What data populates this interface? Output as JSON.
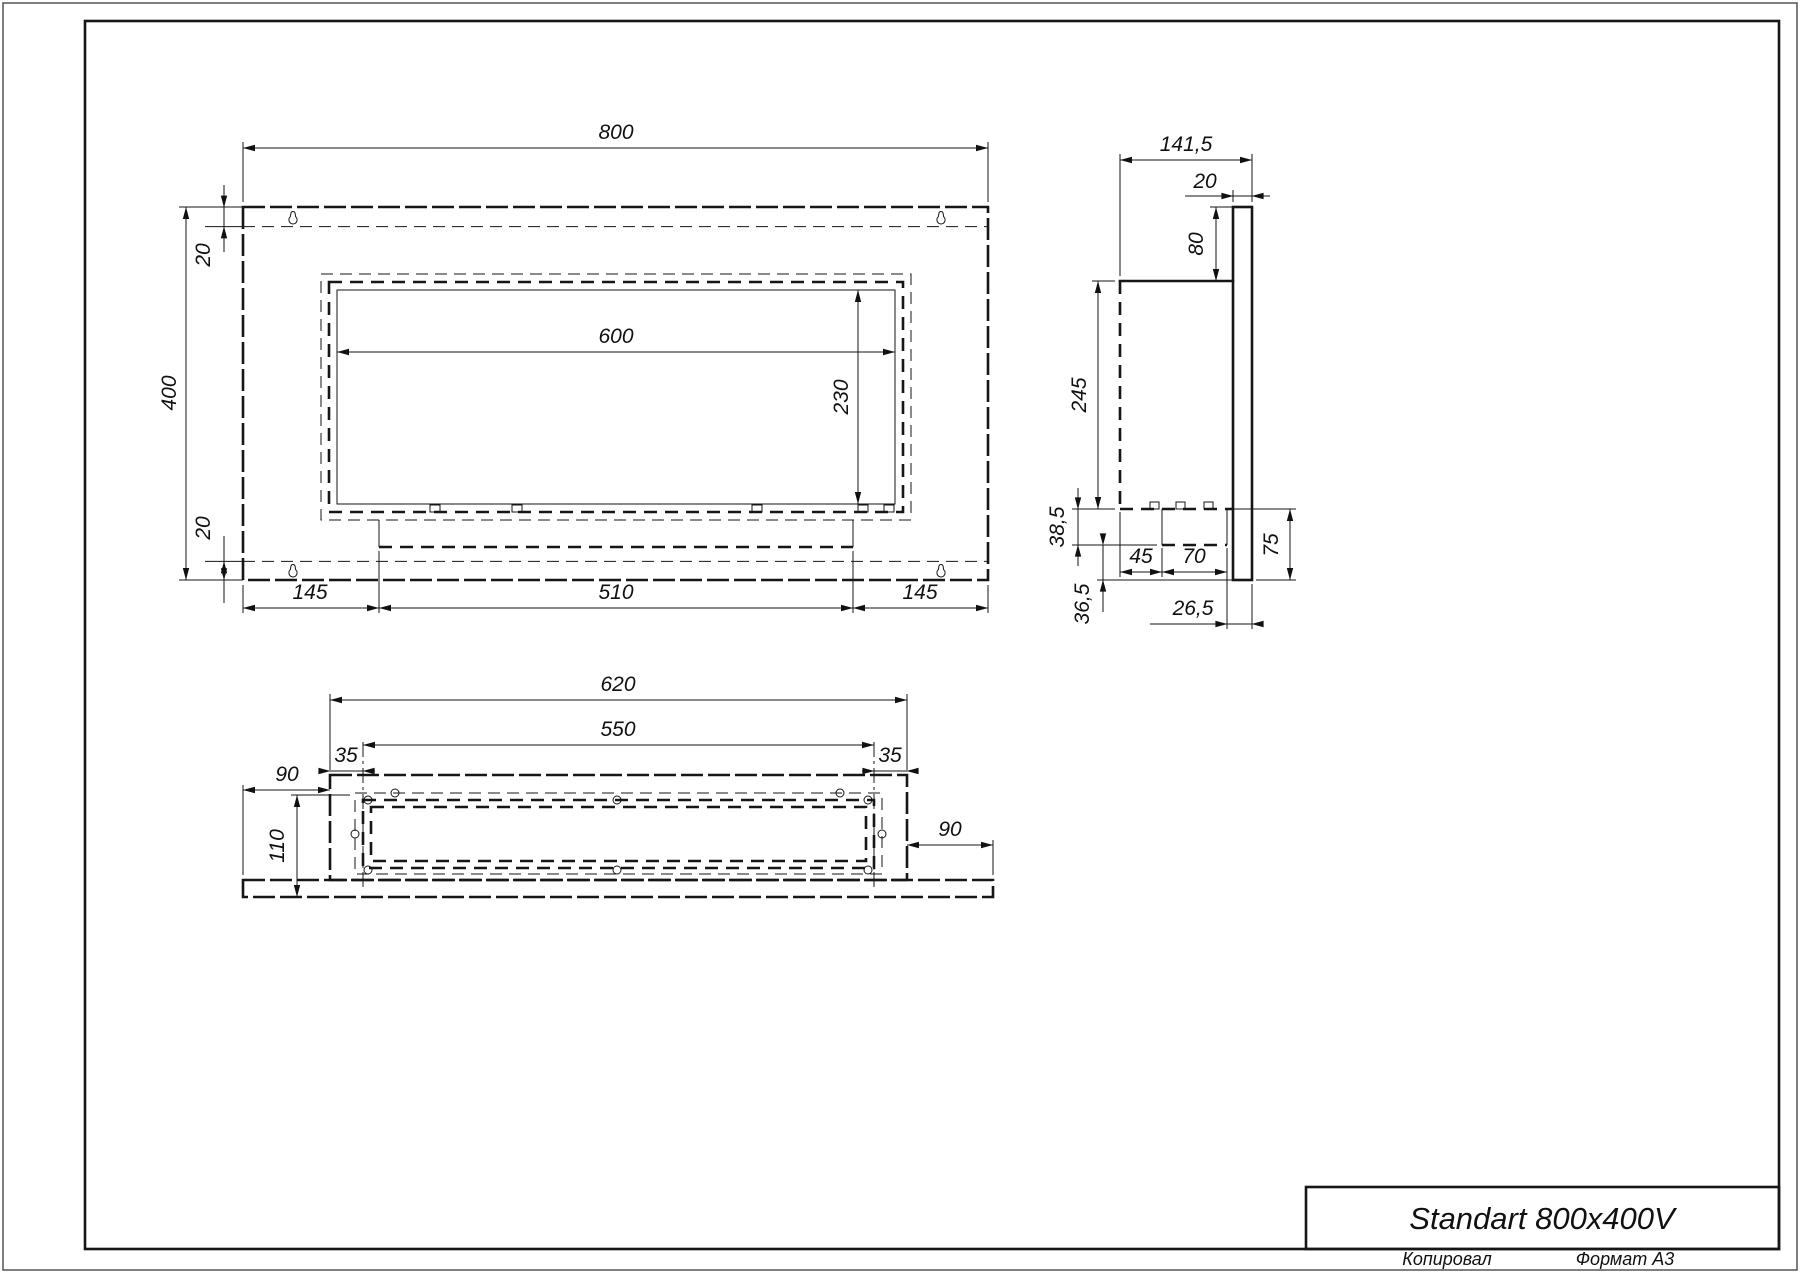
{
  "title_block": {
    "title": "Standart 800x400V",
    "copied_label": "Копировал",
    "format_label": "Формат А3"
  },
  "front_view": {
    "dims": {
      "overall_width": "800",
      "overall_height": "400",
      "top_flange": "20",
      "bottom_flange": "20",
      "opening_width": "600",
      "opening_height": "230",
      "bottom_left": "145",
      "bottom_center": "510",
      "bottom_right": "145"
    }
  },
  "side_view": {
    "dims": {
      "overall_depth": "141,5",
      "panel_thickness": "20",
      "top_offset": "80",
      "body_height": "245",
      "tray_depth": "38,5",
      "below_tray": "36,5",
      "tray_setback": "45",
      "tray_width": "70",
      "panel_below_body": "75",
      "tray_to_back": "26,5"
    }
  },
  "bottom_view": {
    "dims": {
      "body_width": "620",
      "hole_span": "550",
      "left_inset": "35",
      "right_inset": "35",
      "left_overhang": "90",
      "right_overhang": "90",
      "depth": "110"
    }
  }
}
